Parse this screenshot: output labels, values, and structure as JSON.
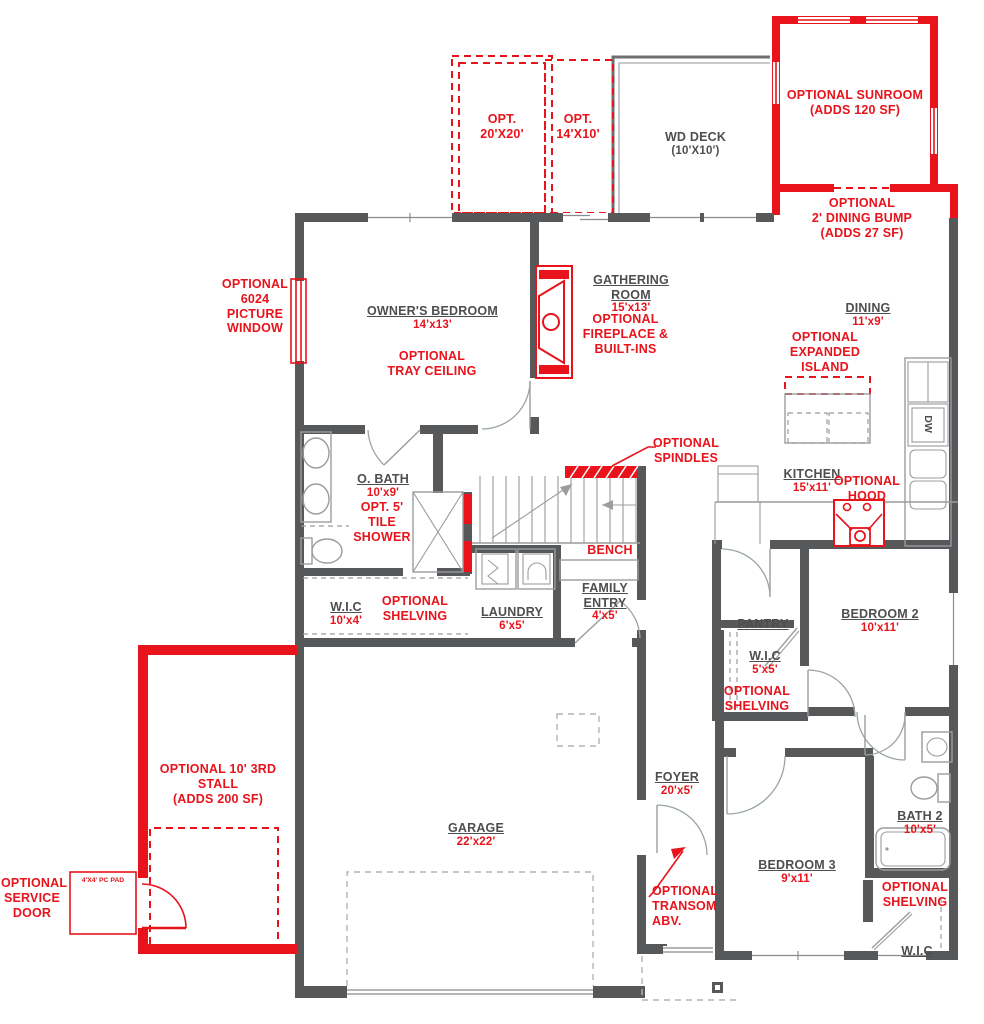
{
  "title": "First floor plan with optional features",
  "palette": {
    "wall_dark": "#57585a",
    "optional_red": "#e8131b",
    "fixture_gray": "#9b9c9e",
    "dash_gray": "#b3b4b6",
    "text_dark": "#4d4e50",
    "arc_green": "#9aa79a"
  },
  "rooms": {
    "wd_deck": {
      "name": "WD DECK",
      "dim": "(10'X10')"
    },
    "owners_bedroom": {
      "name": "OWNER'S BEDROOM",
      "dim": "14'x13'"
    },
    "gathering_room": {
      "name": "GATHERING\nROOM",
      "dim": "15'x13'"
    },
    "dining": {
      "name": "DINING",
      "dim": "11'x9'"
    },
    "kitchen": {
      "name": "KITCHEN",
      "dim": "15'x11'"
    },
    "o_bath": {
      "name": "O. BATH",
      "dim": "10'x9'"
    },
    "wic_owner": {
      "name": "W.I.C",
      "dim": "10'x4'"
    },
    "laundry": {
      "name": "LAUNDRY",
      "dim": "6'x5'"
    },
    "family_entry": {
      "name": "FAMILY\nENTRY",
      "dim": "4'x5'"
    },
    "pantry": {
      "name": "PANTRY"
    },
    "wic_2": {
      "name": "W.I.C",
      "dim": "5'x5'"
    },
    "bedroom_2": {
      "name": "BEDROOM 2",
      "dim": "10'x11'"
    },
    "garage": {
      "name": "GARAGE",
      "dim": "22'x22'"
    },
    "foyer": {
      "name": "FOYER",
      "dim": "20'x5'"
    },
    "bedroom_3": {
      "name": "BEDROOM 3",
      "dim": "9'x11'"
    },
    "bath_2": {
      "name": "BATH 2",
      "dim": "10'x5'"
    },
    "wic_3": {
      "name": "W.I.C"
    }
  },
  "options": {
    "opt_20x20": "OPT.\n20'X20'",
    "opt_14x10": "OPT.\n14'X10'",
    "sunroom": "OPTIONAL SUNROOM\n(ADDS 120 SF)",
    "dining_bump": "OPTIONAL\n2' DINING BUMP\n(ADDS 27 SF)",
    "picture_window": "OPTIONAL\n6024\nPICTURE\nWINDOW",
    "tray_ceiling": "OPTIONAL\nTRAY CEILING",
    "fireplace": "OPTIONAL\nFIREPLACE &\nBUILT-INS",
    "expanded_island": "OPTIONAL\nEXPANDED\nISLAND",
    "spindles": "OPTIONAL\nSPINDLES",
    "hood": "OPTIONAL\nHOOD",
    "tile_shower": "OPT. 5'\nTILE\nSHOWER",
    "shelving_wic_owner": "OPTIONAL\nSHELVING",
    "bench": "BENCH",
    "shelving_wic_2": "OPTIONAL\nSHELVING",
    "third_stall": "OPTIONAL 10' 3RD\nSTALL\n(ADDS 200 SF)",
    "service_door": "OPTIONAL\nSERVICE\nDOOR",
    "pc_pad": "4'X4' PC PAD",
    "transom": "OPTIONAL\nTRANSOM\nABV.",
    "shelving_wic_3": "OPTIONAL\nSHELVING"
  },
  "appliances": {
    "dishwasher": "DW"
  }
}
